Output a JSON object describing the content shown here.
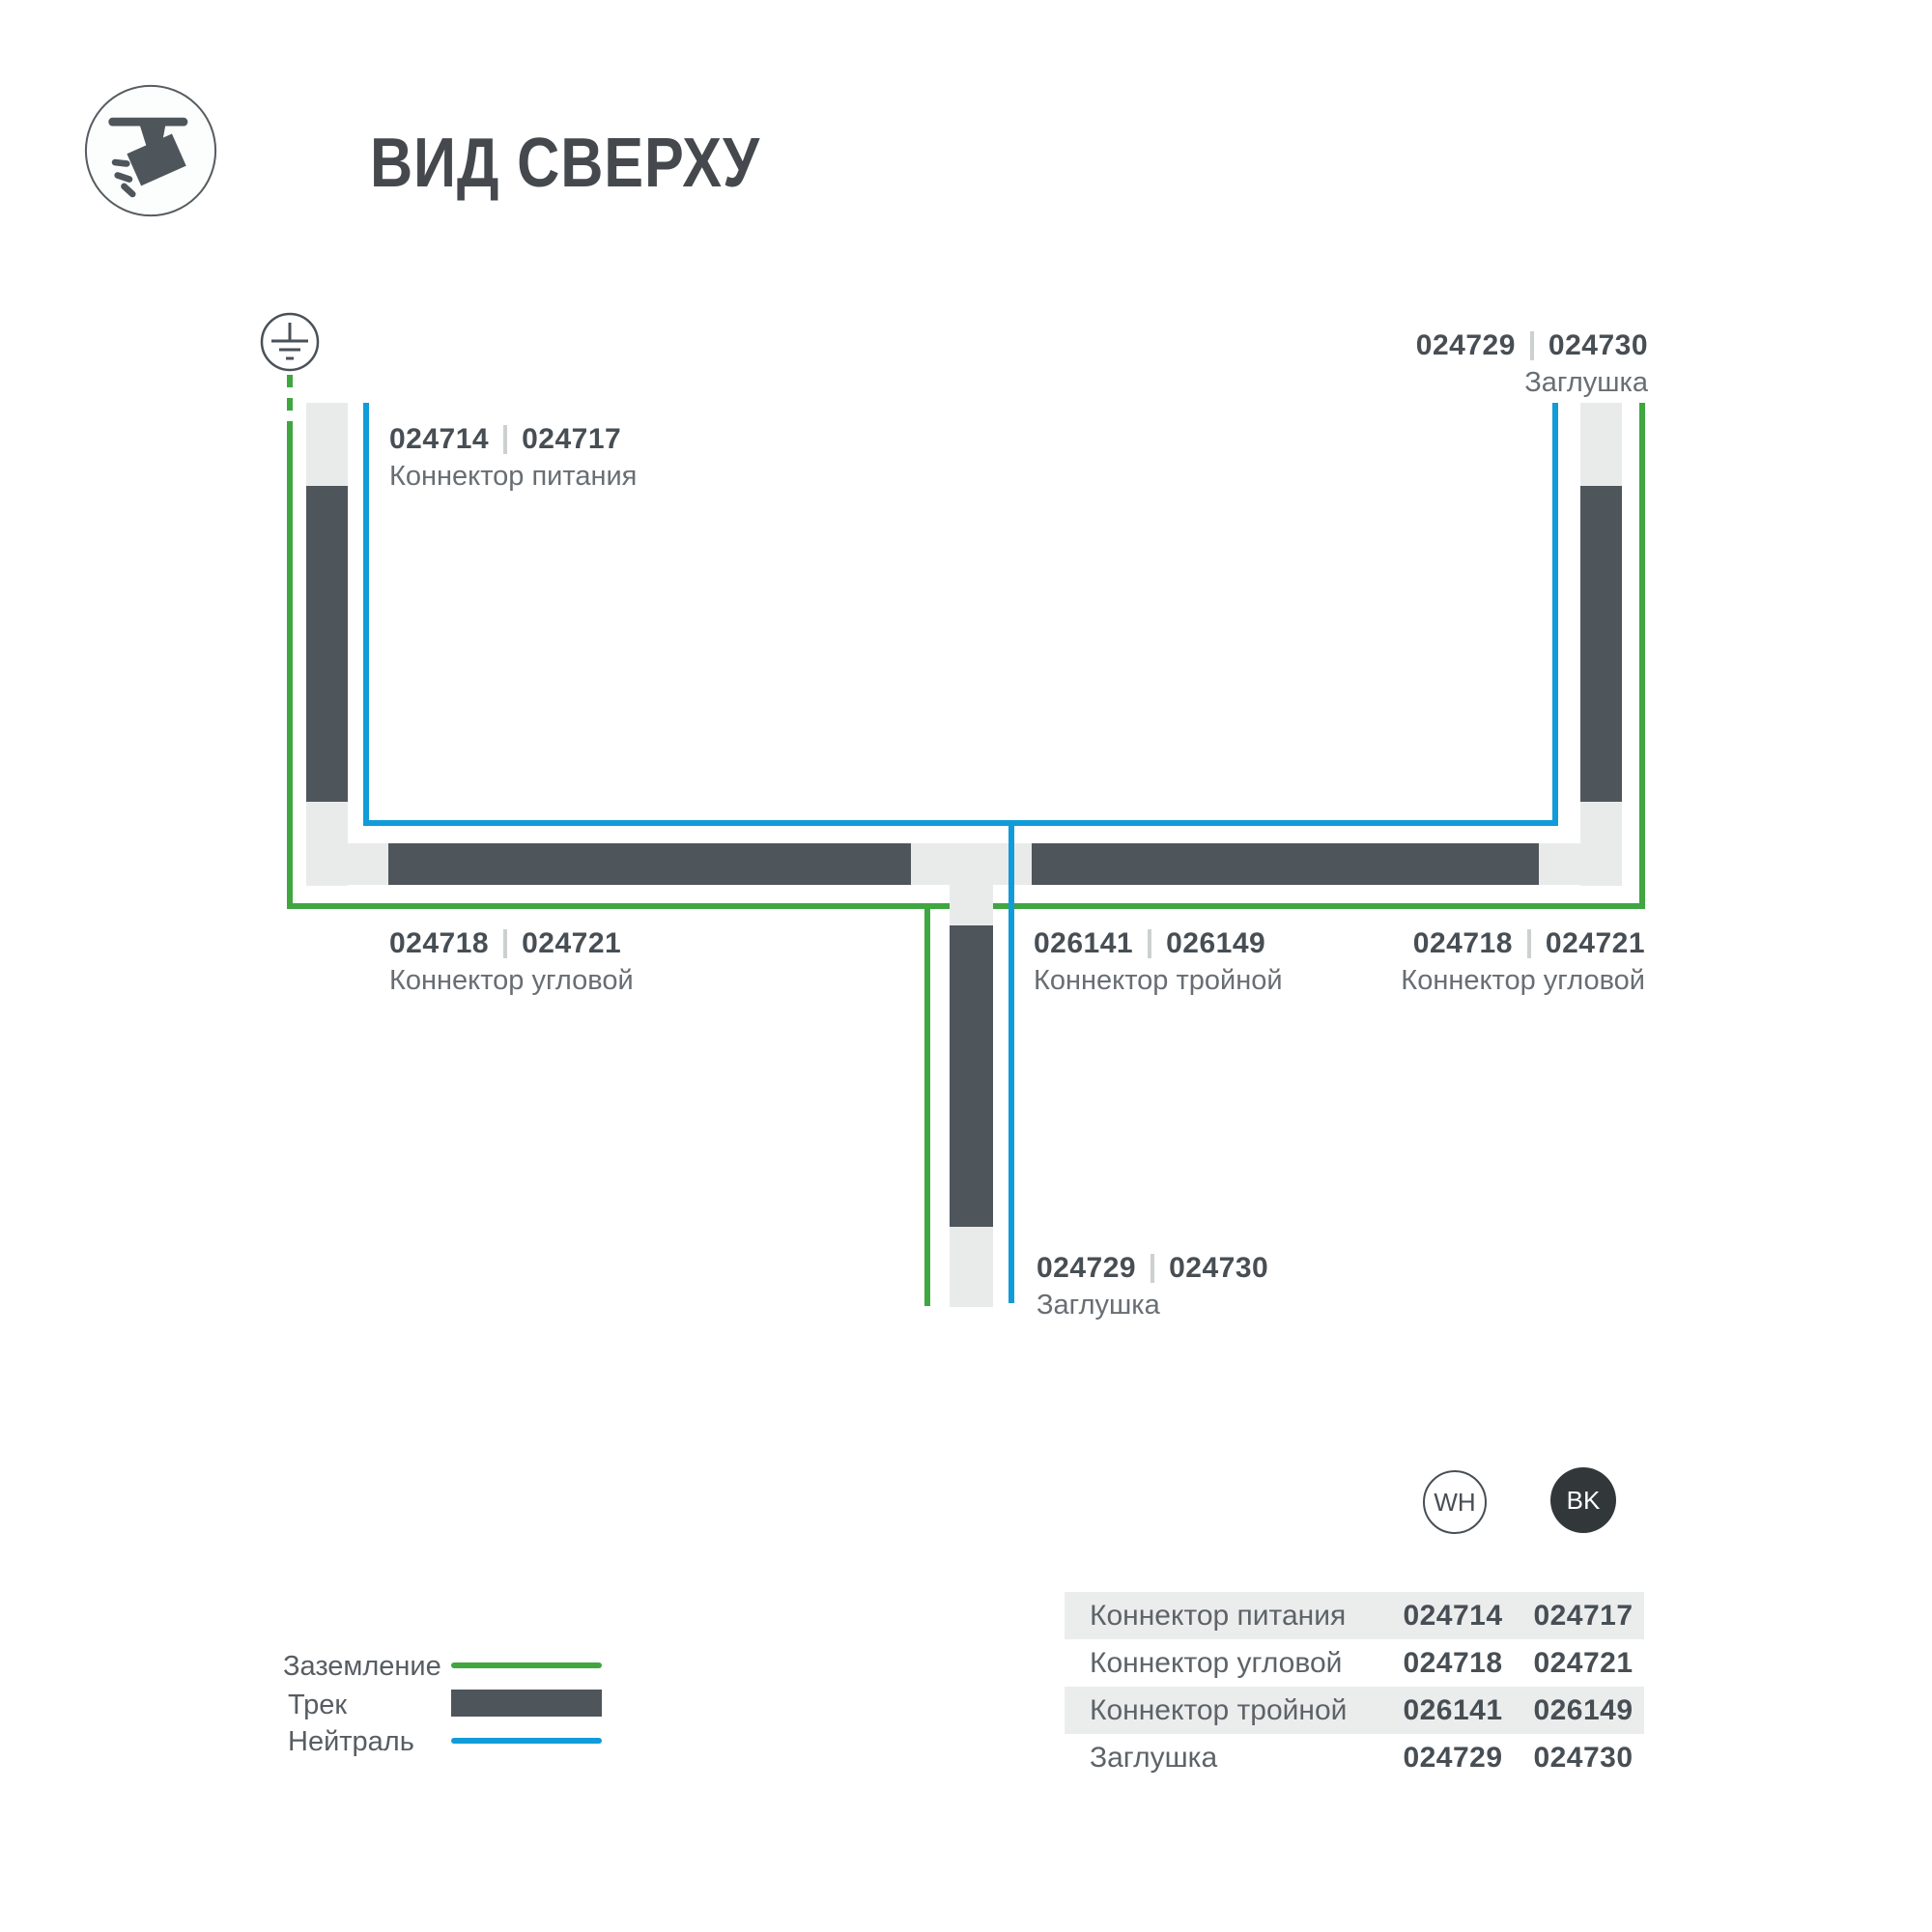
{
  "title": "ВИД СВЕРХУ",
  "colors": {
    "ground_green": "#3fa640",
    "neutral_blue": "#119bd8",
    "track_dark": "#4e555b",
    "track_light": "#e9ebeb",
    "text_dark": "#474e54",
    "text_muted": "#686e73",
    "row_gray": "#ebeded",
    "bk_fill": "#32373a"
  },
  "callouts": {
    "power": {
      "num_wh": "024714",
      "num_bk": "024717",
      "name": "Коннектор питания"
    },
    "end_top": {
      "num_wh": "024729",
      "num_bk": "024730",
      "name": "Заглушка"
    },
    "corner_left": {
      "num_wh": "024718",
      "num_bk": "024721",
      "name": "Коннектор угловой"
    },
    "tee": {
      "num_wh": "026141",
      "num_bk": "026149",
      "name": "Коннектор тройной"
    },
    "corner_right": {
      "num_wh": "024718",
      "num_bk": "024721",
      "name": "Коннектор угловой"
    },
    "end_bottom": {
      "num_wh": "024729",
      "num_bk": "024730",
      "name": "Заглушка"
    }
  },
  "legend": {
    "ground": "Заземление",
    "track": "Трек",
    "neutral": "Нейтраль"
  },
  "swatches": {
    "wh": "WH",
    "bk": "BK"
  },
  "table": {
    "rows": [
      {
        "name": "Коннектор питания",
        "wh": "024714",
        "bk": "024717"
      },
      {
        "name": "Коннектор угловой",
        "wh": "024718",
        "bk": "024721"
      },
      {
        "name": "Коннектор тройной",
        "wh": "026141",
        "bk": "026149"
      },
      {
        "name": "Заглушка",
        "wh": "024729",
        "bk": "024730"
      }
    ]
  }
}
